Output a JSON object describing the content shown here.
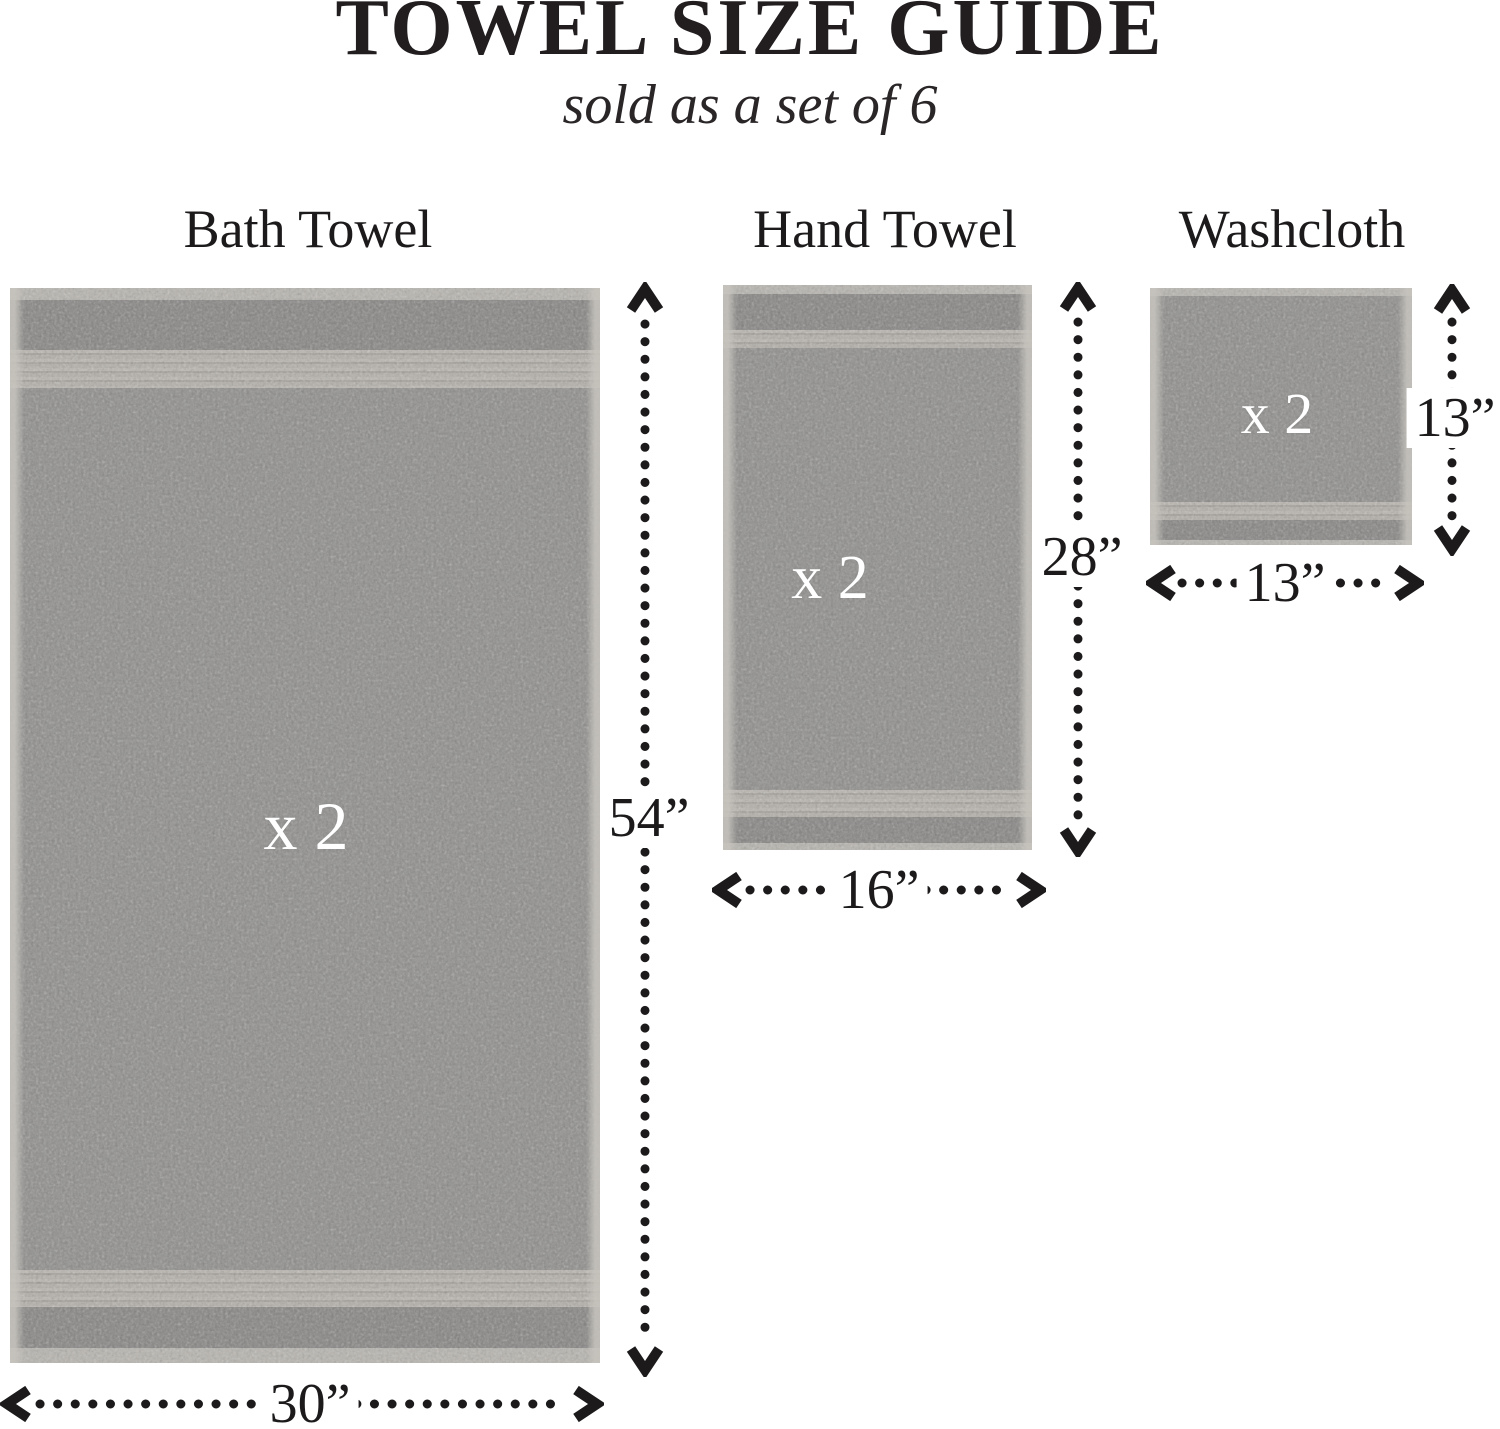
{
  "header": {
    "title": "TOWEL SIZE GUIDE",
    "subtitle": "sold as a set of 6"
  },
  "towels": [
    {
      "name": "Bath Towel",
      "multiplier": "x 2",
      "quantity": 2,
      "width_label": "30”",
      "height_label": "54”",
      "width_in": 30,
      "height_in": 54
    },
    {
      "name": "Hand Towel",
      "multiplier": "x 2",
      "quantity": 2,
      "width_label": "16”",
      "height_label": "28”",
      "width_in": 16,
      "height_in": 28
    },
    {
      "name": "Washcloth",
      "multiplier": "x 2",
      "quantity": 2,
      "width_label": "13”",
      "height_label": "13”",
      "width_in": 13,
      "height_in": 13
    }
  ],
  "colors": {
    "background": "#ffffff",
    "text": "#1c1a1b",
    "towel_base": "#8d8c8a",
    "towel_band_light": "#b7b4ae",
    "multiplier_text": "#ffffff"
  }
}
